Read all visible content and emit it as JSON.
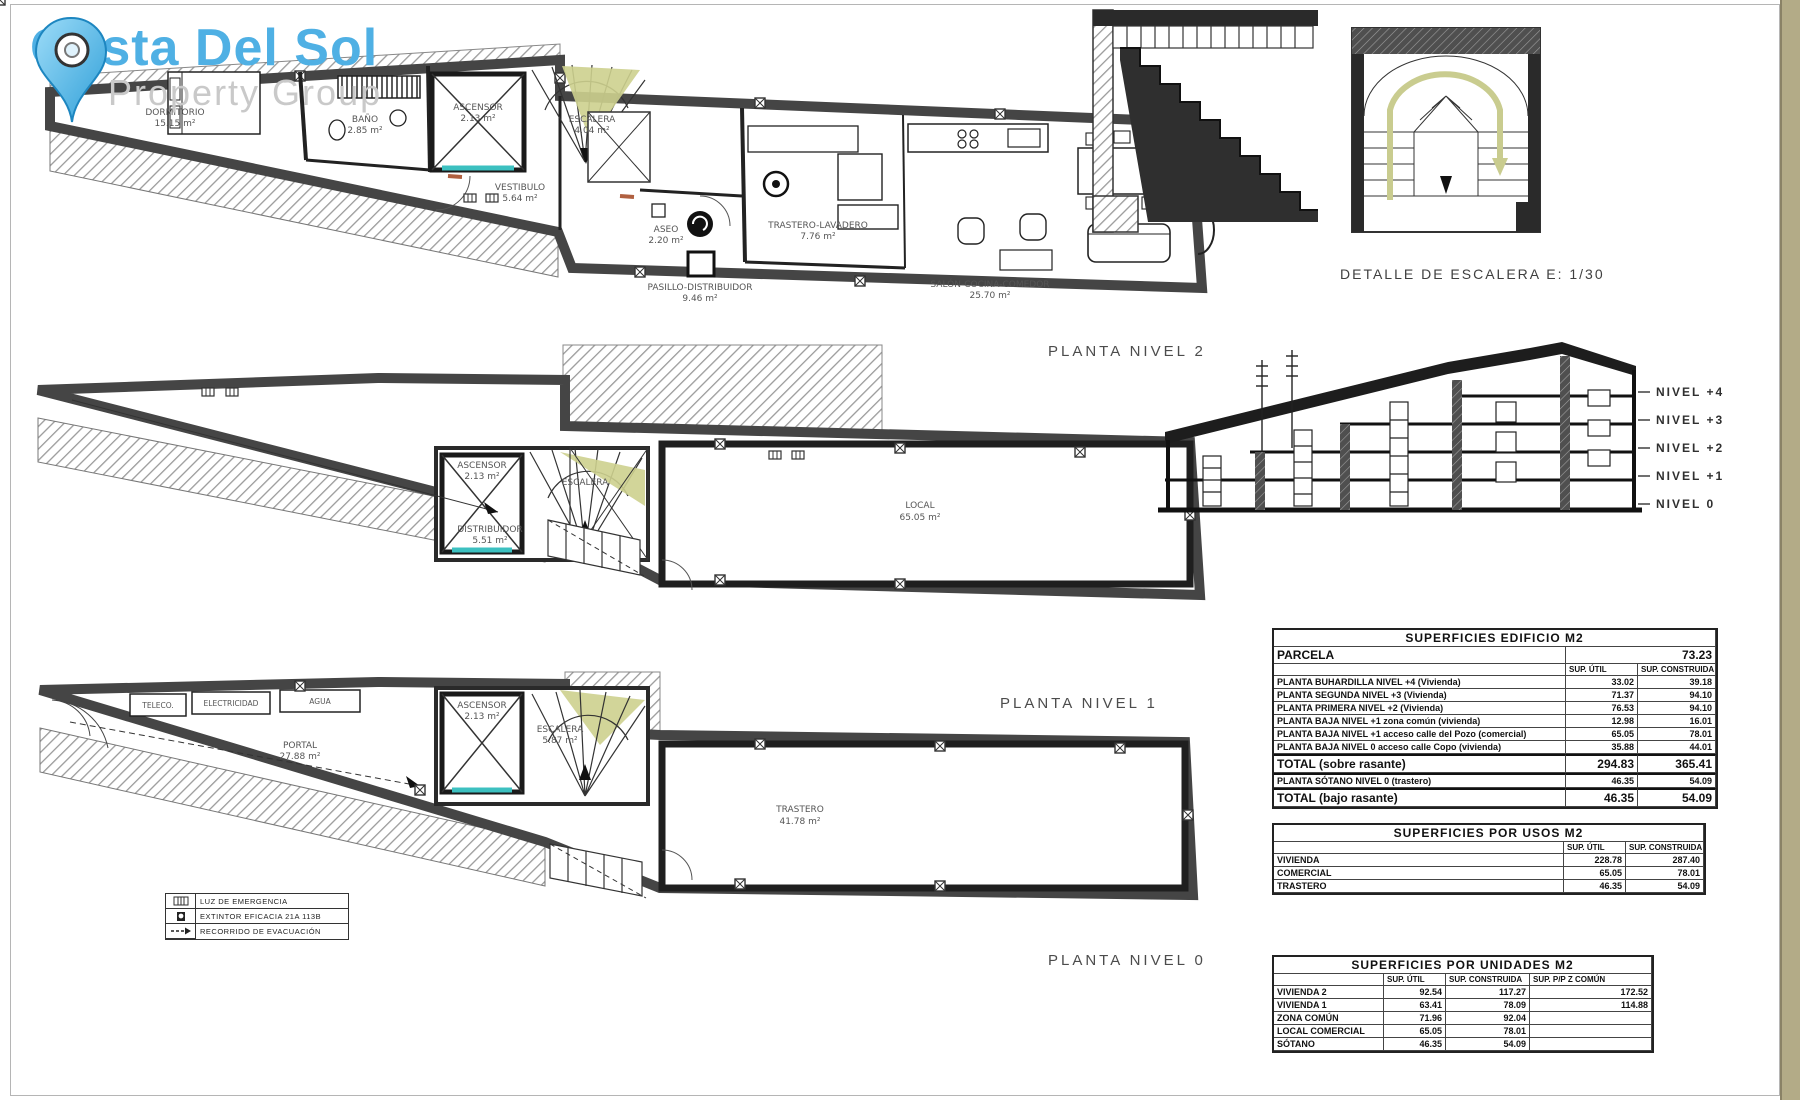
{
  "logo": {
    "title": "Costa Del Sol",
    "subtitle": "Property Group"
  },
  "colors": {
    "brand_blue": "#4fb0e4",
    "subtitle_gray": "#c9c9c9",
    "teal_door": "#3cc0c0",
    "olive_stair": "#cdd08e",
    "tan_border": "#b3ab87",
    "jamb_orange": "#b06040"
  },
  "plans": {
    "level2": {
      "label": "PLANTA NIVEL 2",
      "rooms": [
        {
          "name": "DORMITORIO",
          "area": "15.15 m²"
        },
        {
          "name": "BAÑO",
          "area": "2.85 m²"
        },
        {
          "name": "ASCENSOR",
          "area": "2.13 m²"
        },
        {
          "name": "ESCALERA",
          "area": "4.04 m²"
        },
        {
          "name": "VESTIBULO",
          "area": "5.64 m²"
        },
        {
          "name": "ASEO",
          "area": "2.20 m²"
        },
        {
          "name": "TRASTERO-LAVADERO",
          "area": "7.76 m²"
        },
        {
          "name": "PASILLO-DISTRIBUIDOR",
          "area": "9.46 m²"
        },
        {
          "name": "SALÓN-COCINA-COMEDOR",
          "area": "25.70 m²"
        }
      ]
    },
    "level1": {
      "label": "PLANTA NIVEL 1",
      "rooms": [
        {
          "name": "ASCENSOR",
          "area": "2.13 m²"
        },
        {
          "name": "ESCALERA",
          "area": ""
        },
        {
          "name": "DISTRIBUIDOR",
          "area": "5.51 m²"
        },
        {
          "name": "LOCAL",
          "area": "65.05 m²"
        }
      ]
    },
    "level0": {
      "label": "PLANTA NIVEL 0",
      "rooms": [
        {
          "name": "TELECO.",
          "area": ""
        },
        {
          "name": "ELECTRICIDAD",
          "area": ""
        },
        {
          "name": "AGUA",
          "area": ""
        },
        {
          "name": "PORTAL",
          "area": "27.88 m²"
        },
        {
          "name": "ASCENSOR",
          "area": "2.13 m²"
        },
        {
          "name": "ESCALERA",
          "area": "5.87 m²"
        },
        {
          "name": "TRASTERO",
          "area": "41.78 m²"
        }
      ]
    }
  },
  "stair_detail": {
    "caption": "DETALLE DE ESCALERA E: 1/30"
  },
  "section": {
    "levels": [
      "NIVEL +4",
      "NIVEL +3",
      "NIVEL +2",
      "NIVEL +1",
      "NIVEL 0"
    ]
  },
  "legend": {
    "items": [
      {
        "label": "LUZ DE EMERGENCIA"
      },
      {
        "label": "EXTINTOR EFICACIA 21A 113B"
      },
      {
        "label": "RECORRIDO DE EVACUACIÓN"
      }
    ]
  },
  "tables": {
    "edificio": {
      "title": "SUPERFICIES EDIFICIO M2",
      "parcela_label": "PARCELA",
      "parcela_value": "73.23",
      "col_util": "SUP. ÚTIL",
      "col_constr": "SUP. CONSTRUIDA",
      "rows": [
        {
          "name": "PLANTA BUHARDILLA NIVEL +4 (Vivienda)",
          "util": "33.02",
          "constr": "39.18"
        },
        {
          "name": "PLANTA SEGUNDA NIVEL +3 (Vivienda)",
          "util": "71.37",
          "constr": "94.10"
        },
        {
          "name": "PLANTA PRIMERA NIVEL +2 (Vivienda)",
          "util": "76.53",
          "constr": "94.10"
        },
        {
          "name": "PLANTA BAJA NIVEL +1 zona común (vivienda)",
          "util": "12.98",
          "constr": "16.01"
        },
        {
          "name": "PLANTA BAJA NIVEL +1 acceso calle del Pozo (comercial)",
          "util": "65.05",
          "constr": "78.01"
        },
        {
          "name": "PLANTA BAJA NIVEL 0 acceso calle Copo (vivienda)",
          "util": "35.88",
          "constr": "44.01"
        }
      ],
      "total_sobre": {
        "name": "TOTAL (sobre rasante)",
        "util": "294.83",
        "constr": "365.41"
      },
      "sotano": {
        "name": "PLANTA SÓTANO NIVEL 0 (trastero)",
        "util": "46.35",
        "constr": "54.09"
      },
      "total_bajo": {
        "name": "TOTAL (bajo rasante)",
        "util": "46.35",
        "constr": "54.09"
      }
    },
    "usos": {
      "title": "SUPERFICIES POR USOS M2",
      "col_util": "SUP. ÚTIL",
      "col_constr": "SUP. CONSTRUIDA",
      "rows": [
        {
          "name": "VIVIENDA",
          "util": "228.78",
          "constr": "287.40"
        },
        {
          "name": "COMERCIAL",
          "util": "65.05",
          "constr": "78.01"
        },
        {
          "name": "TRASTERO",
          "util": "46.35",
          "constr": "54.09"
        }
      ]
    },
    "unidades": {
      "title": "SUPERFICIES POR UNIDADES M2",
      "col_util": "SUP. ÚTIL",
      "col_constr": "SUP. CONSTRUIDA",
      "col_comun": "SUP. P/P Z COMÚN",
      "rows": [
        {
          "name": "VIVIENDA 2",
          "util": "92.54",
          "constr": "117.27",
          "comun": "172.52"
        },
        {
          "name": "VIVIENDA 1",
          "util": "63.41",
          "constr": "78.09",
          "comun": "114.88"
        },
        {
          "name": "ZONA COMÚN",
          "util": "71.96",
          "constr": "92.04",
          "comun": ""
        },
        {
          "name": "LOCAL COMERCIAL",
          "util": "65.05",
          "constr": "78.01",
          "comun": ""
        },
        {
          "name": "SÓTANO",
          "util": "46.35",
          "constr": "54.09",
          "comun": ""
        }
      ]
    }
  }
}
